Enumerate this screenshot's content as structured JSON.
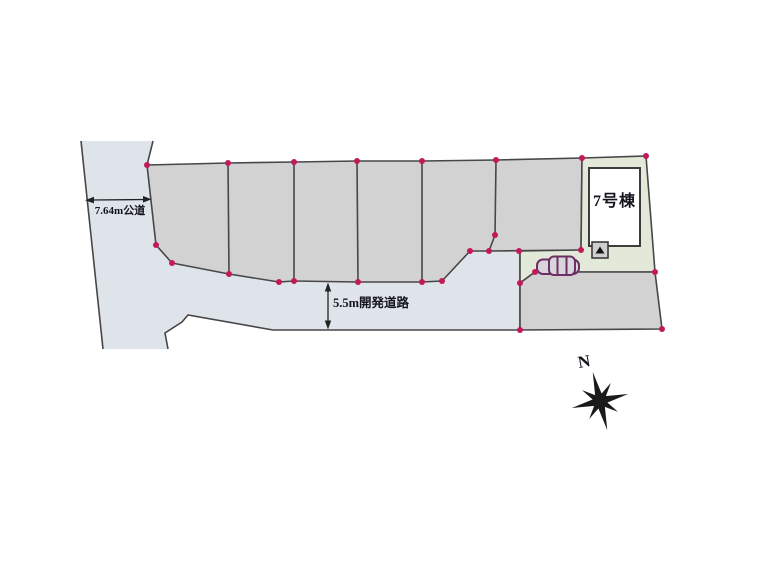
{
  "site_plan": {
    "labels": {
      "west_road": "7.64m公道",
      "dev_road": "5.5m開発道路",
      "building": "7号棟",
      "compass_north": "N"
    },
    "colors": {
      "background": "#ffffff",
      "lot_fill": "#d2d2d2",
      "road_fill": "#dfe4eb",
      "green_lot_fill": "#e3e9d8",
      "building_fill": "#ffffff",
      "boundary_line": "#474747",
      "corner_dot": "#c2195b",
      "car_outline": "#6d2e63",
      "text": "#14141f",
      "compass": "#1a1a1a"
    }
  }
}
